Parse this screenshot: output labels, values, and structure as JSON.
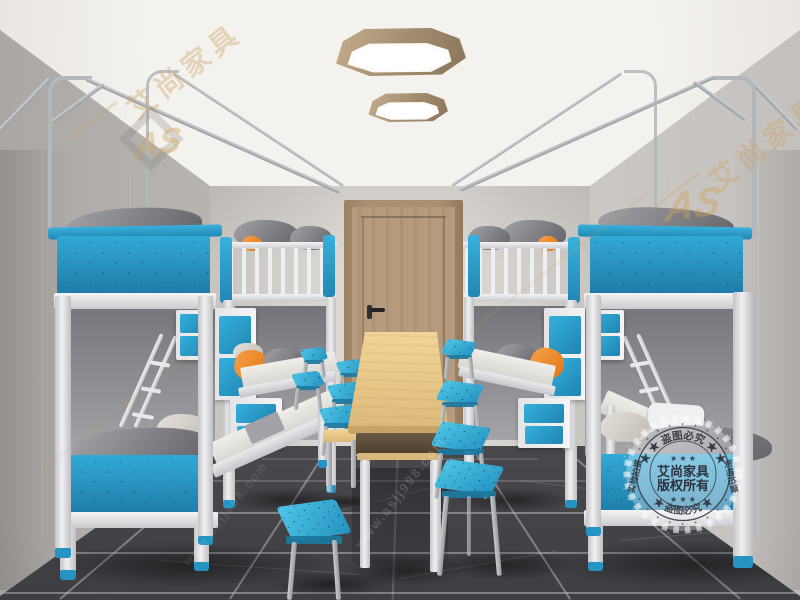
{
  "image": {
    "type": "3d-interior-render",
    "subject": "student dormitory room with four metal bunk beds, long wooden study table, blue stools, wooden door and two wooden ceiling lamps"
  },
  "branding": {
    "brand_name": "艾尚家具",
    "logo_monogram": "AS",
    "watermark_url": "www.asjj998.com"
  },
  "stamp": {
    "top_arc": "★ ★ 盗图必究 ★ ★",
    "bottom_arc": "★ 盗图必究 ★",
    "left_text": "实物拍摄",
    "right_text": "实物拍摄",
    "stars": "★ ★ ★",
    "center_line1": "艾尚家具",
    "center_line2": "版权所有"
  },
  "palette": {
    "bed_blue": "#2b9fcd",
    "stool_cyan": "#3cb8de",
    "frame_white": "#ececef",
    "door_wood": "#b59a7c",
    "table_wood": "#e9c98b",
    "wall_grey": "#cdcac6",
    "floor_marble": "#55555a",
    "accent_orange": "#f08a28",
    "watermark_gold": "#c8a468"
  },
  "scene": {
    "objects": [
      "bunk-bed-left-near",
      "bunk-bed-left-far",
      "bunk-bed-right-near",
      "bunk-bed-right-far",
      "study-table",
      "bench",
      "blue-stools",
      "ceiling-lamps",
      "wooden-door",
      "curtain-rails",
      "copyright-stamp"
    ]
  }
}
